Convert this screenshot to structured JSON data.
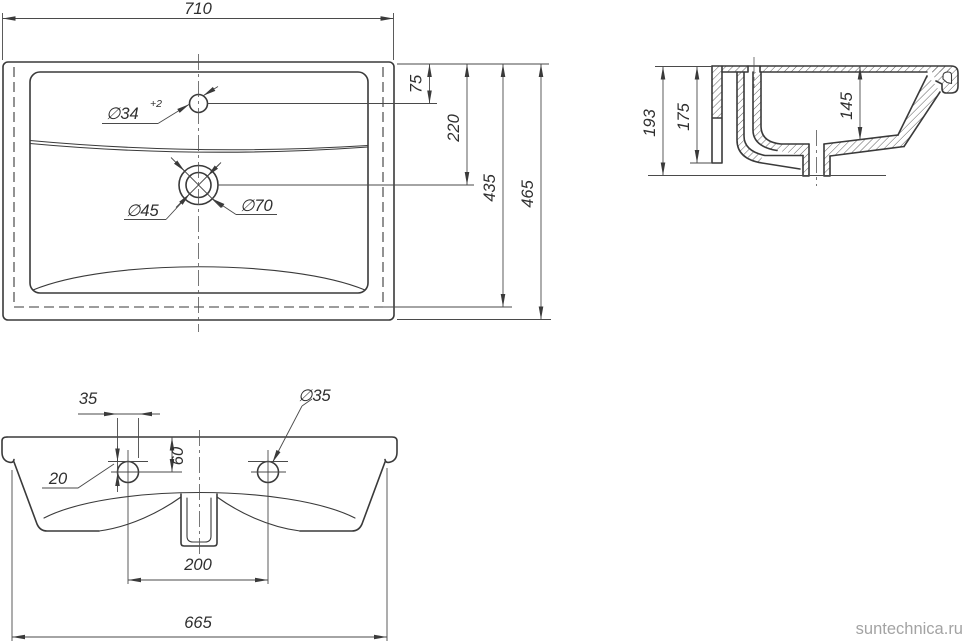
{
  "drawing": {
    "title": "washbasin-technical-drawing",
    "dims": {
      "tv_width": "710",
      "tv_faucet_offset": "75",
      "tv_drain_offset": "220",
      "tv_inner_depth": "435",
      "tv_depth": "465",
      "tv_faucet_hole": "∅34",
      "tv_faucet_tol": "+2",
      "tv_drain_inner": "∅45",
      "tv_drain_outer": "∅70",
      "sv_height": "193",
      "sv_back_height": "175",
      "sv_bowl_depth": "145",
      "fv_hole_width": "35",
      "fv_ledge_offset": "20",
      "fv_hole_top_offset": "60",
      "fv_hole_dia": "∅35",
      "fv_hole_spacing": "200",
      "fv_width": "665"
    },
    "watermark": "suntechnica.ru"
  }
}
